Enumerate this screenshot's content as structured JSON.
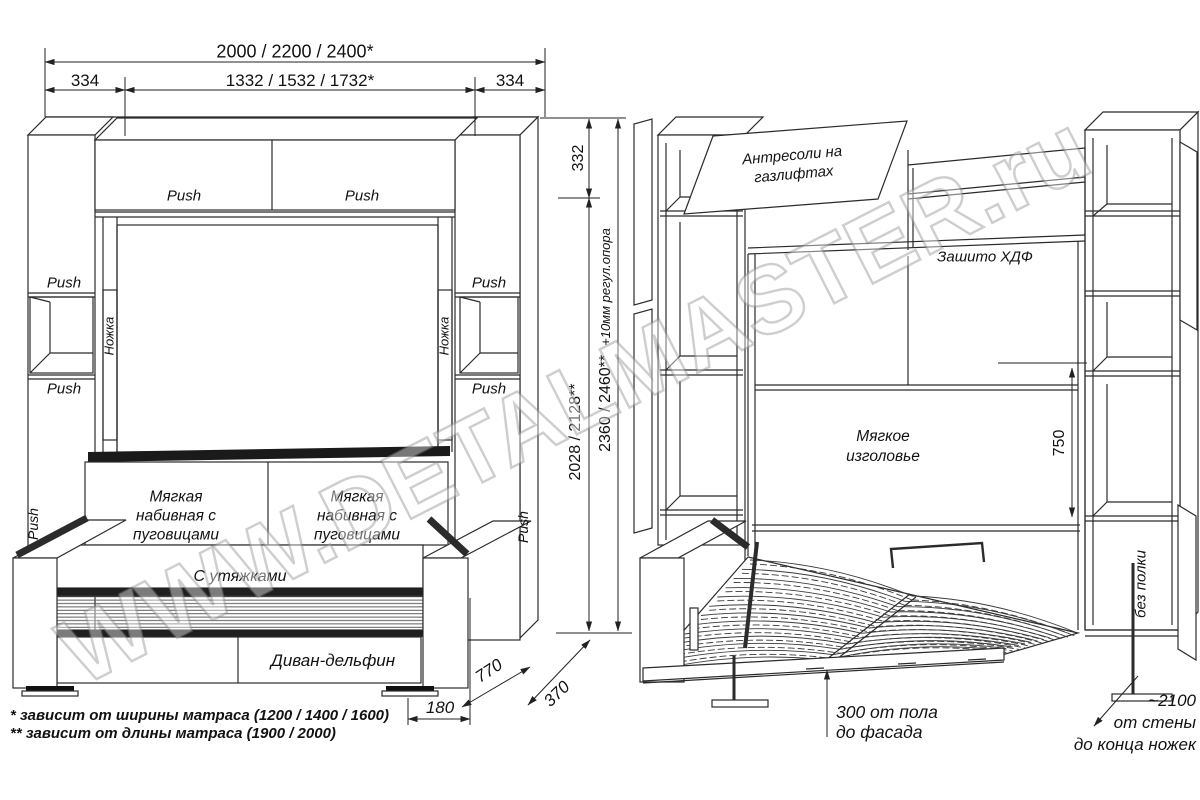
{
  "watermark": "WWW.DETALMASTER.ru",
  "colors": {
    "line": "#2b2b2b",
    "accent_black": "#1a1a1a",
    "background": "#ffffff",
    "watermark": "#9a9a9a"
  },
  "closed_view": {
    "dim_total_width": "2000 / 2200 / 2400*",
    "dim_side_left": "334",
    "dim_inner_width": "1332 / 1532 / 1732*",
    "dim_side_right": "334",
    "dim_cornice_height": "332",
    "dim_inner_height": "2028 / 2128**",
    "dim_total_height": "2360 / 2460**",
    "dim_height_note": "+10мм регул.опора",
    "dim_sofa_depth": "770",
    "dim_upper_depth": "370",
    "dim_side_depth": "180",
    "push": "Push",
    "leg_label": "Ножка",
    "cushion_left": "Мягкая набивная с пуговицами",
    "cushion_right": "Мягкая набивная с пуговицами",
    "ties_label": "С утяжками",
    "sofa_label": "Диван-дельфин"
  },
  "open_view": {
    "antresol_label": "Антресоли на газлифтах",
    "hdf_label": "Зашито ХДФ",
    "headboard_label": "Мягкое изголовье",
    "dim_headboard": "750",
    "no_shelf_label": "без полки",
    "floor_note_line1": "300 от пола",
    "floor_note_line2": "до фасада",
    "wall_note_line1": "~2100",
    "wall_note_line2": "от стены",
    "wall_note_line3": "до конца ножек"
  },
  "footnotes": {
    "line1": "* зависит от ширины матраса (1200 / 1400 / 1600)",
    "line2": "** зависит от длины матраса (1900 / 2000)"
  }
}
